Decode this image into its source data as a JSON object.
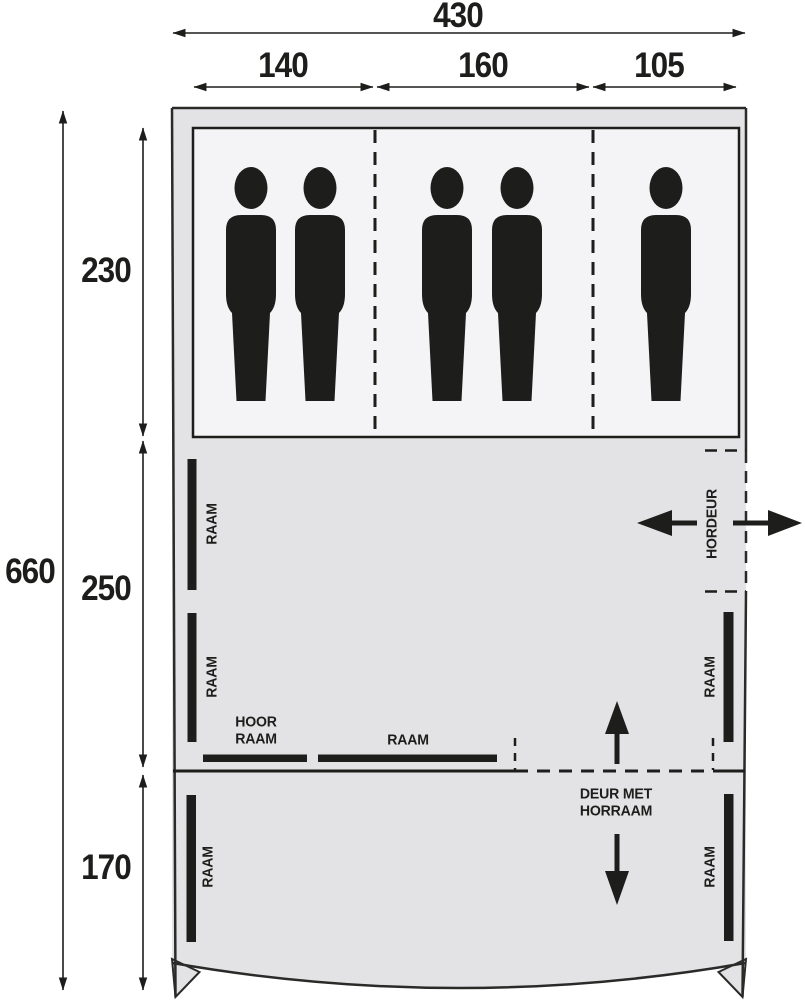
{
  "plan": {
    "title_semantics": "tent floor plan",
    "dim_total_width": "430",
    "dim_widths": [
      "140",
      "160",
      "105"
    ],
    "dim_total_height": "660",
    "dim_heights": [
      "230",
      "250",
      "170"
    ],
    "window_label": "RAAM",
    "screen_door_label": "HORDEUR",
    "side_window_label_line1": "HOOR",
    "side_window_label_line2": "RAAM",
    "front_door_label_line1": "DEUR MET",
    "front_door_label_line2": "HORRAAM",
    "persons": {
      "count": 5,
      "per_compartment": [
        2,
        2,
        1
      ]
    },
    "colors": {
      "tent_fill": "#e3e3e5",
      "cabin_fill": "#f4f4f6",
      "ink": "#1d1d1b"
    }
  }
}
